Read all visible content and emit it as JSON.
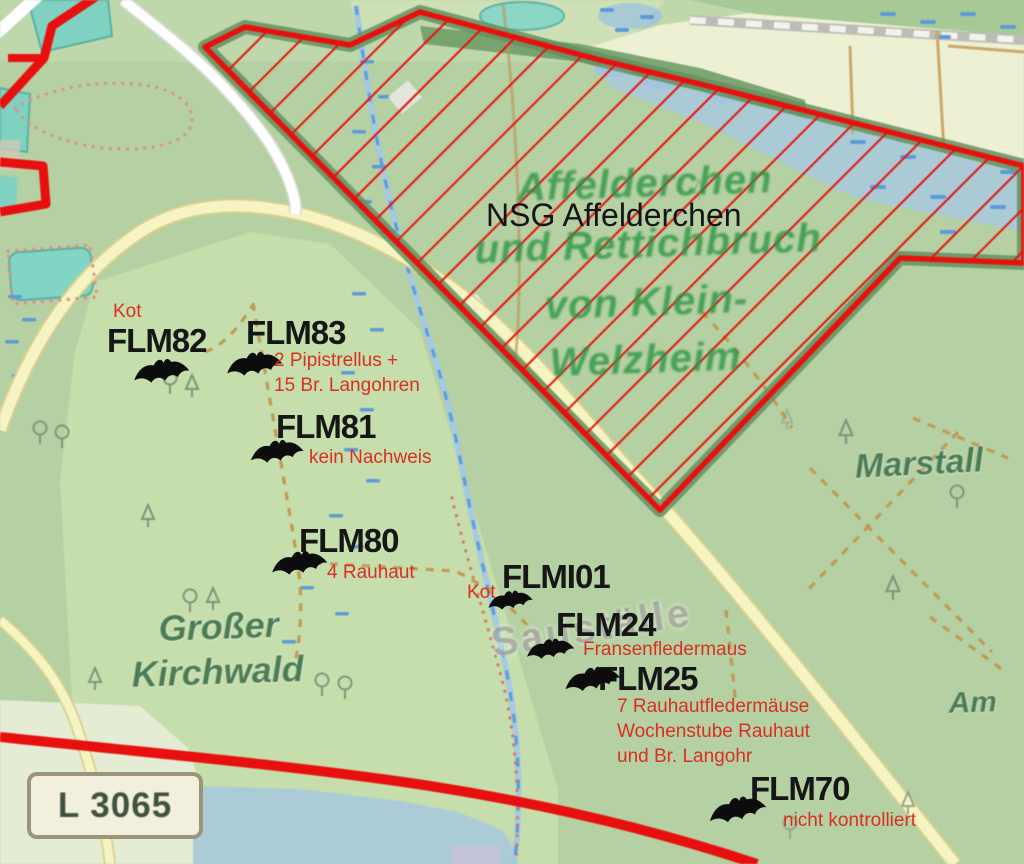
{
  "map": {
    "region_label": "NSG Affelderchen",
    "ghost_label_lines": [
      "Affelderchen",
      "und Rettichbruch",
      "von Klein-",
      "Welzheim"
    ],
    "place_labels": {
      "forest_left_line1": "Großer",
      "forest_left_line2": "Kirchwald",
      "forest_right": "Marstall",
      "partial_right": "Am",
      "ghost_gray": "Sauställe"
    },
    "road_sign": {
      "label": "L 3065"
    },
    "markers": [
      {
        "id": "FLM82",
        "note_lines": [
          "Kot"
        ],
        "label": {
          "x": 107,
          "y": 324
        },
        "bat": {
          "x": 131,
          "y": 356,
          "w": 60,
          "rot": -8
        },
        "note": {
          "x": 113,
          "y": 299
        }
      },
      {
        "id": "FLM83",
        "note_lines": [
          "2 Pipistrellus +",
          "15 Br. Langohren"
        ],
        "label": {
          "x": 246,
          "y": 316
        },
        "bat": {
          "x": 224,
          "y": 349,
          "w": 60,
          "rot": -8
        },
        "note": {
          "x": 274,
          "y": 348
        }
      },
      {
        "id": "FLM81",
        "note_lines": [
          "kein Nachweis"
        ],
        "label": {
          "x": 276,
          "y": 410
        },
        "bat": {
          "x": 248,
          "y": 437,
          "w": 57,
          "rot": -8
        },
        "note": {
          "x": 309,
          "y": 445
        }
      },
      {
        "id": "FLM80",
        "note_lines": [
          "4 Rauhaut"
        ],
        "label": {
          "x": 299,
          "y": 524
        },
        "bat": {
          "x": 269,
          "y": 548,
          "w": 60,
          "rot": -8
        },
        "note": {
          "x": 327,
          "y": 560
        }
      },
      {
        "id": "FLMI01",
        "note_lines": [
          "Kot"
        ],
        "label": {
          "x": 502,
          "y": 560
        },
        "bat": {
          "x": 486,
          "y": 588,
          "w": 48,
          "rot": -8
        },
        "note": {
          "x": 467,
          "y": 580
        }
      },
      {
        "id": "FLM24",
        "note_lines": [
          "Fransenfledermaus"
        ],
        "label": {
          "x": 556,
          "y": 608
        },
        "bat": {
          "x": 524,
          "y": 636,
          "w": 52,
          "rot": -8
        },
        "note": {
          "x": 583,
          "y": 637
        }
      },
      {
        "id": "FLM25",
        "note_lines": [
          "7 Rauhautfledermäuse",
          "Wochenstube Rauhaut",
          "und Br. Langohr"
        ],
        "label": {
          "x": 598,
          "y": 662
        },
        "bat": {
          "x": 562,
          "y": 664,
          "w": 60,
          "rot": -10
        },
        "note": {
          "x": 617,
          "y": 694
        }
      },
      {
        "id": "FLM70",
        "note_lines": [
          "nicht kontrolliert"
        ],
        "label": {
          "x": 750,
          "y": 772
        },
        "bat": {
          "x": 706,
          "y": 794,
          "w": 62,
          "rot": -12
        },
        "note": {
          "x": 783,
          "y": 808
        }
      }
    ],
    "colors": {
      "boundary_red": "#e8100e",
      "annotation_red": "#d93025",
      "label_black": "#161616",
      "ghost_green": "#289442",
      "place_green": "#4c7c55",
      "road_yellow": "#f7f4c4",
      "water_blue": "#a3c8e6",
      "teal_field": "#7fd2c2",
      "forest_green": "#b5d0a2",
      "sign_bg": "#f2efdc"
    }
  }
}
